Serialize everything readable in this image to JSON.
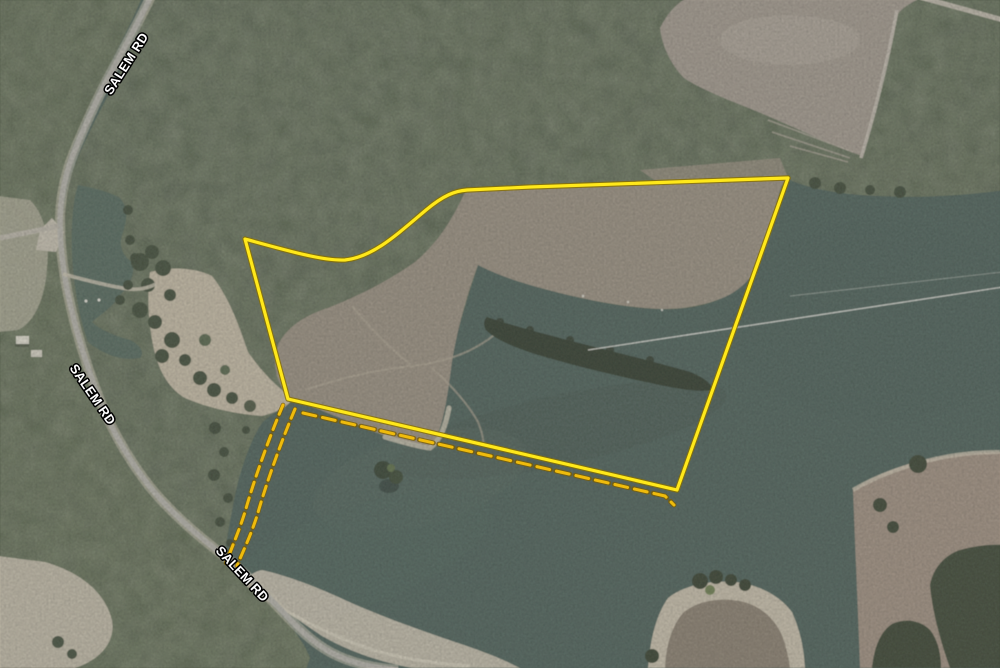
{
  "map": {
    "road_labels": [
      {
        "text": "SALEM RD"
      },
      {
        "text": "SALEM RD"
      },
      {
        "text": "SALEM RD"
      }
    ],
    "label_style": {
      "fill": "#ffffff",
      "halo": "#000000"
    },
    "parcel": {
      "boundary_color": "#FFE81A",
      "boundary_halo_color": "#8A7000",
      "dashed_color": "#EFBB0C",
      "dashed_halo_color": "#7E5F00",
      "boundary_path": "M 245,239 C 292,252 324,261 345,260 C 372,257 393,238 426,210 C 444,195 455,191 467,190 L 530,187 L 788,178 L 677,490 L 288,399 Z",
      "south_dashed_path": "M 303,413 L 665,496 L 674,505",
      "access_dashed_west_path": "M 283,405 C 272,431 258,468 247,505 C 241,527 231,549 226,563",
      "access_dashed_east_path": "M 295,409 C 284,435 270,472 259,509 C 253,531 243,551 237,566"
    }
  }
}
